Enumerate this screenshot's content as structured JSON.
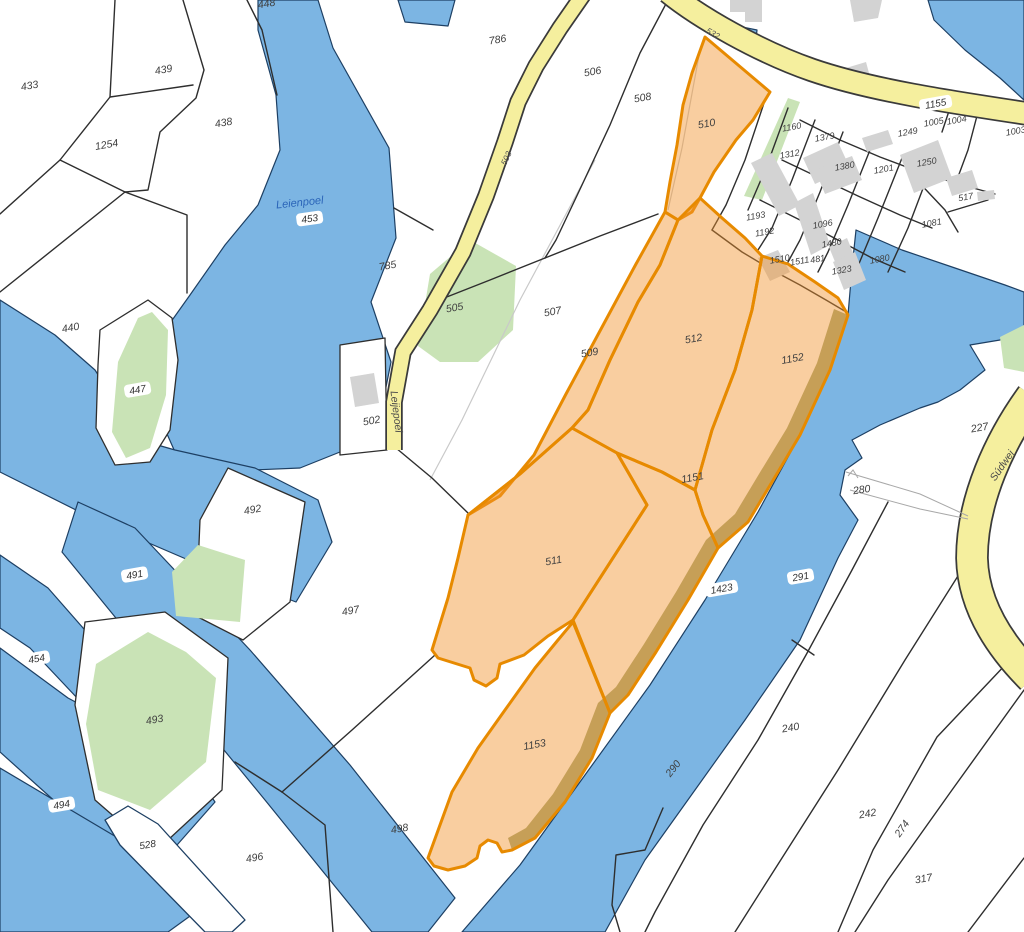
{
  "map_title": "cadastral-parcel-map",
  "colors": {
    "water": "#7cb5e3",
    "waterline": "#1d3f63",
    "green": "#c9e3b6",
    "road_fill": "#f5ef9e",
    "road_casing": "#3a3a3a",
    "boundary": "#2e2e2e",
    "building": "#d3d3d3",
    "selected_fill": "rgba(242,146,44,0.45)",
    "selected_stroke": "#e78a00",
    "olive_bank": "#99a06b",
    "label_color": "#3f3f3f",
    "water_label_color": "#2a64b8",
    "faint_line": "#c9c9c9",
    "track_line": "#a8a8a8"
  },
  "water": [
    {
      "name": "leienpoel-lake",
      "pts": "258,0 318,0 333,48 389,148 396,238 371,302 391,362 377,432 340,452 300,468 253,470 175,452 152,400 158,340 190,295 225,245 258,205 280,150 276,95 258,30"
    },
    {
      "name": "top-pond",
      "pts": "398,0 455,0 448,26 405,22"
    },
    {
      "name": "west-marsh",
      "pts": "0,300 55,335 95,370 140,440 175,450 255,468 318,500 332,542 296,602 200,565 100,522 0,472"
    },
    {
      "name": "channel-491",
      "pts": "78,502 135,528 250,650 350,765 455,898 428,932 372,932 265,800 160,672 62,552"
    },
    {
      "name": "channel-454",
      "pts": "0,555 48,588 162,718 128,752 30,648 0,628"
    },
    {
      "name": "pond-494",
      "pts": "0,648 68,698 188,762 215,802 162,862 78,822 0,752"
    },
    {
      "name": "bottom-left-water",
      "pts": "0,768 118,838 215,898 168,932 0,932"
    },
    {
      "name": "river",
      "pts": "856,230 902,250 955,268 1005,285 1024,292 1024,330 1000,340 970,345 985,370 960,390 938,402 920,408 880,425 852,440 862,458 845,470 840,495 858,520 838,558 800,640 745,720 695,790 645,860 605,932 462,932 520,865 585,775 650,685 705,600 758,512 800,435 830,370 848,315 852,268"
    },
    {
      "name": "road-pond",
      "pts": "737,26 757,30 755,48 734,44"
    },
    {
      "name": "top-right-water",
      "pts": "928,0 1024,0 1024,100 1000,78 965,50 934,20"
    }
  ],
  "islands": [
    {
      "name": "parcel-447-margin",
      "pts": "100,330 148,300 172,318 178,360 170,430 150,462 115,465 96,428 98,365"
    },
    {
      "name": "parcel-492",
      "pts": "228,468 305,502 290,602 243,640 196,616 200,520"
    },
    {
      "name": "parcel-493-margin",
      "pts": "85,622 165,612 228,658 222,790 155,852 95,800 75,705"
    },
    {
      "name": "parcel-502",
      "pts": "340,345 385,338 387,450 340,455"
    },
    {
      "name": "band-528",
      "pts": "128,806 158,824 245,920 232,932 205,932 120,845 105,820"
    }
  ],
  "greens": [
    {
      "name": "green-505",
      "pts": "470,240 516,266 513,330 478,362 440,362 418,346 430,274"
    },
    {
      "name": "green-village-strip",
      "pts": "788,98 800,102 762,200 744,196"
    },
    {
      "name": "green-447",
      "pts": "152,312 168,330 166,395 150,448 126,458 112,432 118,362 138,318"
    },
    {
      "name": "green-492",
      "pts": "198,545 245,560 240,622 176,616 172,572"
    },
    {
      "name": "green-493",
      "pts": "148,632 186,652 216,678 206,762 150,810 98,790 86,724 96,664"
    },
    {
      "name": "green-right-edge",
      "pts": "1000,337 1024,325 1024,372 1004,368"
    }
  ],
  "faint_lines": [
    {
      "name": "old-boundary-510",
      "pts": "700,50 682,148 668,210"
    },
    {
      "name": "old-boundary-507",
      "pts": "595,160 520,300 462,420 430,480"
    }
  ],
  "boundaries": [
    {
      "pts": "115,0 110,97 60,160 0,214"
    },
    {
      "pts": "110,97 193,85"
    },
    {
      "pts": "183,0 204,70 196,98 160,132 148,190 125,192"
    },
    {
      "pts": "125,192 60,160"
    },
    {
      "pts": "0,292 125,192"
    },
    {
      "pts": "125,192 187,215 187,293"
    },
    {
      "pts": "247,0 262,30 277,95"
    },
    {
      "pts": "394,208 433,230"
    },
    {
      "pts": "668,0 640,53 610,125 582,185 556,240 545,258"
    },
    {
      "pts": "545,258 490,280 434,302"
    },
    {
      "pts": "545,258 600,236 658,214"
    },
    {
      "pts": "396,448 432,478 468,513"
    },
    {
      "pts": "435,655 352,730 282,792"
    },
    {
      "pts": "282,792 325,825 333,932"
    },
    {
      "pts": "282,792 235,762"
    },
    {
      "pts": "888,502 852,570 806,655 758,740 703,825 655,912 645,932"
    },
    {
      "pts": "792,640 814,655"
    },
    {
      "pts": "963,568 905,660 838,770 768,880 735,932"
    },
    {
      "pts": "1008,662 937,737 873,850 838,932"
    },
    {
      "pts": "1024,690 952,790 888,880 855,932"
    },
    {
      "pts": "1024,858 968,932"
    },
    {
      "pts": "663,808 645,850 616,855 612,905 620,932"
    },
    {
      "pts": "765,100 745,160 726,205 712,230"
    },
    {
      "pts": "712,230 742,252 772,270 800,285 826,300 848,313"
    },
    {
      "pts": "800,120 840,140 880,157 920,172 955,183 995,194"
    },
    {
      "pts": "782,160 820,178 858,196 900,215 932,228"
    },
    {
      "pts": "760,200 800,220 838,240 872,258 905,272"
    },
    {
      "pts": "788,108 766,168 748,210"
    },
    {
      "pts": "815,120 792,180 772,228 758,250"
    },
    {
      "pts": "843,132 820,192 800,240 788,262"
    },
    {
      "pts": "872,145 848,205 828,252 818,272"
    },
    {
      "pts": "902,158 878,218 858,266 846,285"
    },
    {
      "pts": "930,170 908,228 888,272"
    },
    {
      "pts": "950,108 942,132"
    },
    {
      "pts": "978,112 968,150 955,185"
    },
    {
      "pts": "912,175 945,210 958,232"
    },
    {
      "pts": "948,212 988,200"
    }
  ],
  "buildings": [
    {
      "pts": "730,0 762,0 762,22 745,22 745,12 730,12"
    },
    {
      "pts": "850,0 882,0 878,18 854,22"
    },
    {
      "pts": "846,68 866,62 872,84 852,90"
    },
    {
      "pts": "803,158 838,142 850,168 815,184"
    },
    {
      "pts": "815,170 852,156 862,180 825,194"
    },
    {
      "pts": "751,163 772,153 800,205 779,216"
    },
    {
      "pts": "900,155 938,140 952,178 914,193"
    },
    {
      "pts": "946,178 972,170 978,188 952,196"
    },
    {
      "pts": "977,192 994,190 995,199 978,201"
    },
    {
      "pts": "862,138 888,130 893,144 867,152"
    },
    {
      "pts": "794,203 813,193 830,245 811,255"
    },
    {
      "pts": "829,247 847,238 862,275 844,284"
    },
    {
      "pts": "833,262 855,252 866,280 844,290"
    },
    {
      "pts": "758,258 778,250 790,272 770,281"
    },
    {
      "pts": "350,377 374,373 379,403 355,407"
    }
  ],
  "roads": [
    {
      "name": "road-main-1155",
      "d": "M 668,-8 C 700,18 760,52 812,70 C 870,90 950,102 1030,114",
      "w": 21
    },
    {
      "name": "road-leijepoel",
      "d": "M 585,-8 L 560,28 L 536,66 L 518,102 L 505,142 L 486,196 L 463,252 L 430,310 L 403,352 L 394,402 L 394,450",
      "w": 14
    },
    {
      "name": "road-sudwei",
      "d": "M 1032,396 C 1000,440 972,500 972,558 C 973,602 996,642 1032,678",
      "w": 30
    }
  ],
  "tracks": [
    {
      "pts": "846,472 920,494 968,516"
    },
    {
      "pts": "850,490 920,509 968,519"
    },
    {
      "pts": "848,476 853,470 858,478"
    }
  ],
  "olive_bank": {
    "pts": "848,315 830,370 800,435 772,482 748,522 718,548 688,600 656,652 628,695 610,713 592,758 565,802 535,838 512,850 508,838 526,828 553,794 580,750 598,703 616,687 644,644 676,592 706,540 735,514 759,474 787,428 817,363 834,309"
  },
  "selected_parcels": [
    {
      "id": "510",
      "pts": "705,37 770,92 753,120 736,140 714,172 700,198 692,212 678,220 665,212 670,182 677,145 683,105 692,73"
    },
    {
      "id": "509",
      "pts": "665,212 678,220 660,265 638,302 610,360 588,410 572,428 520,474 468,515 500,496 534,455 566,394 601,329 636,264"
    },
    {
      "id": "512",
      "pts": "678,220 700,198 722,218 745,238 762,256 752,310 735,370 712,430 695,490 662,472 617,453 572,428 588,410 610,360 638,302 660,265"
    },
    {
      "id": "1152",
      "pts": "762,256 788,264 815,282 838,298 848,315 830,370 800,435 772,482 748,522 718,548 703,515 695,490 712,430 735,370 752,310"
    },
    {
      "id": "1151",
      "pts": "617,453 662,472 695,490 703,515 718,548 688,600 656,652 628,695 610,713 573,620 647,505"
    },
    {
      "id": "511",
      "pts": "468,515 520,474 572,428 617,453 647,505 573,620 548,636 524,655 500,664 497,678 486,686 474,680 470,668 438,658 432,650 448,598 458,558"
    },
    {
      "id": "1153",
      "pts": "573,622 610,713 592,758 565,802 535,838 512,850 502,852 497,843 488,840 480,846 477,858 465,866 448,870 434,866 428,858 452,792 478,748 505,710 535,668 558,640"
    }
  ],
  "labels": [
    {
      "text": "433",
      "x": 30,
      "y": 88,
      "rot": -10,
      "style": "plain"
    },
    {
      "text": "439",
      "x": 164,
      "y": 72,
      "rot": -10,
      "style": "plain"
    },
    {
      "text": "438",
      "x": 224,
      "y": 125,
      "rot": -10,
      "style": "plain"
    },
    {
      "text": "1254",
      "x": 107,
      "y": 147,
      "rot": -10,
      "style": "plain"
    },
    {
      "text": "448",
      "x": 267,
      "y": 6,
      "rot": -10,
      "style": "plain"
    },
    {
      "text": "Leienpoel",
      "x": 300,
      "y": 205,
      "rot": -6,
      "style": "water"
    },
    {
      "text": "453",
      "x": 310,
      "y": 221,
      "rot": -8,
      "style": "badge"
    },
    {
      "text": "786",
      "x": 498,
      "y": 42,
      "rot": -10,
      "style": "plain"
    },
    {
      "text": "785",
      "x": 388,
      "y": 268,
      "rot": -10,
      "style": "plain"
    },
    {
      "text": "506",
      "x": 593,
      "y": 74,
      "rot": -10,
      "style": "plain"
    },
    {
      "text": "508",
      "x": 643,
      "y": 100,
      "rot": -10,
      "style": "plain"
    },
    {
      "text": "507",
      "x": 553,
      "y": 314,
      "rot": -10,
      "style": "plain"
    },
    {
      "text": "505",
      "x": 455,
      "y": 310,
      "rot": -10,
      "style": "plain"
    },
    {
      "text": "502",
      "x": 372,
      "y": 423,
      "rot": -10,
      "style": "plain"
    },
    {
      "text": "440",
      "x": 71,
      "y": 330,
      "rot": -10,
      "style": "plain"
    },
    {
      "text": "447",
      "x": 138,
      "y": 392,
      "rot": -10,
      "style": "badge"
    },
    {
      "text": "492",
      "x": 253,
      "y": 512,
      "rot": -10,
      "style": "plain"
    },
    {
      "text": "491",
      "x": 135,
      "y": 577,
      "rot": -10,
      "style": "badge"
    },
    {
      "text": "497",
      "x": 351,
      "y": 613,
      "rot": -10,
      "style": "plain"
    },
    {
      "text": "454",
      "x": 37,
      "y": 661,
      "rot": -10,
      "style": "badge"
    },
    {
      "text": "493",
      "x": 155,
      "y": 722,
      "rot": -10,
      "style": "plain"
    },
    {
      "text": "494",
      "x": 62,
      "y": 807,
      "rot": -10,
      "style": "badge"
    },
    {
      "text": "528",
      "x": 148,
      "y": 847,
      "rot": -10,
      "style": "badge"
    },
    {
      "text": "496",
      "x": 255,
      "y": 860,
      "rot": -10,
      "style": "plain"
    },
    {
      "text": "498",
      "x": 400,
      "y": 831,
      "rot": -10,
      "style": "plain"
    },
    {
      "text": "510",
      "x": 707,
      "y": 126,
      "rot": -10,
      "style": "plain"
    },
    {
      "text": "509",
      "x": 590,
      "y": 355,
      "rot": -10,
      "style": "plain"
    },
    {
      "text": "512",
      "x": 694,
      "y": 341,
      "rot": -10,
      "style": "plain"
    },
    {
      "text": "1152",
      "x": 793,
      "y": 361,
      "rot": -10,
      "style": "plain"
    },
    {
      "text": "1151",
      "x": 693,
      "y": 480,
      "rot": -10,
      "style": "plain"
    },
    {
      "text": "511",
      "x": 554,
      "y": 563,
      "rot": -10,
      "style": "plain"
    },
    {
      "text": "1153",
      "x": 535,
      "y": 747,
      "rot": -10,
      "style": "plain"
    },
    {
      "text": "1423",
      "x": 722,
      "y": 591,
      "rot": -10,
      "style": "badge"
    },
    {
      "text": "291",
      "x": 801,
      "y": 579,
      "rot": -10,
      "style": "badge"
    },
    {
      "text": "290",
      "x": 675,
      "y": 770,
      "rot": -52,
      "style": "plain"
    },
    {
      "text": "280",
      "x": 862,
      "y": 492,
      "rot": -8,
      "style": "plain"
    },
    {
      "text": "240",
      "x": 791,
      "y": 730,
      "rot": -10,
      "style": "plain"
    },
    {
      "text": "242",
      "x": 868,
      "y": 816,
      "rot": -10,
      "style": "plain"
    },
    {
      "text": "274",
      "x": 904,
      "y": 830,
      "rot": -55,
      "style": "plain"
    },
    {
      "text": "317",
      "x": 924,
      "y": 881,
      "rot": -10,
      "style": "plain"
    },
    {
      "text": "227",
      "x": 980,
      "y": 430,
      "rot": -10,
      "style": "plain"
    },
    {
      "text": "1155",
      "x": 936,
      "y": 106,
      "rot": -10,
      "style": "badge"
    },
    {
      "text": "1005",
      "x": 934,
      "y": 124,
      "rot": -10,
      "style": "small"
    },
    {
      "text": "1004",
      "x": 957,
      "y": 122,
      "rot": -10,
      "style": "small"
    },
    {
      "text": "1003",
      "x": 1016,
      "y": 133,
      "rot": -10,
      "style": "small"
    },
    {
      "text": "1249",
      "x": 908,
      "y": 134,
      "rot": -10,
      "style": "small"
    },
    {
      "text": "1250",
      "x": 927,
      "y": 164,
      "rot": -10,
      "style": "small"
    },
    {
      "text": "1380",
      "x": 845,
      "y": 168,
      "rot": -10,
      "style": "small"
    },
    {
      "text": "1379",
      "x": 825,
      "y": 139,
      "rot": -10,
      "style": "small"
    },
    {
      "text": "1160",
      "x": 792,
      "y": 129,
      "rot": -10,
      "style": "small"
    },
    {
      "text": "1312",
      "x": 790,
      "y": 156,
      "rot": -10,
      "style": "small"
    },
    {
      "text": "1201",
      "x": 884,
      "y": 171,
      "rot": -10,
      "style": "small"
    },
    {
      "text": "1193",
      "x": 756,
      "y": 218,
      "rot": -10,
      "style": "small"
    },
    {
      "text": "1192",
      "x": 765,
      "y": 234,
      "rot": -10,
      "style": "small"
    },
    {
      "text": "1096",
      "x": 823,
      "y": 226,
      "rot": -10,
      "style": "small"
    },
    {
      "text": "1480",
      "x": 832,
      "y": 245,
      "rot": -10,
      "style": "small"
    },
    {
      "text": "1510",
      "x": 780,
      "y": 261,
      "rot": -10,
      "style": "small"
    },
    {
      "text": "1511",
      "x": 800,
      "y": 263,
      "rot": -10,
      "style": "small"
    },
    {
      "text": "481",
      "x": 818,
      "y": 261,
      "rot": -10,
      "style": "small"
    },
    {
      "text": "1323",
      "x": 842,
      "y": 272,
      "rot": -10,
      "style": "small"
    },
    {
      "text": "1080",
      "x": 880,
      "y": 261,
      "rot": -10,
      "style": "small"
    },
    {
      "text": "1081",
      "x": 932,
      "y": 225,
      "rot": -10,
      "style": "small"
    },
    {
      "text": "517",
      "x": 966,
      "y": 199,
      "rot": -10,
      "style": "small"
    },
    {
      "text": "503",
      "x": 508,
      "y": 159,
      "rot": -65,
      "style": "roadnum"
    },
    {
      "text": "532",
      "x": 712,
      "y": 35,
      "rot": 30,
      "style": "roadnum"
    },
    {
      "text": "Leijepoel",
      "x": 394,
      "y": 412,
      "rot": 83,
      "style": "roadname"
    },
    {
      "text": "Súdwei",
      "x": 1004,
      "y": 467,
      "rot": -55,
      "style": "roadname"
    }
  ]
}
